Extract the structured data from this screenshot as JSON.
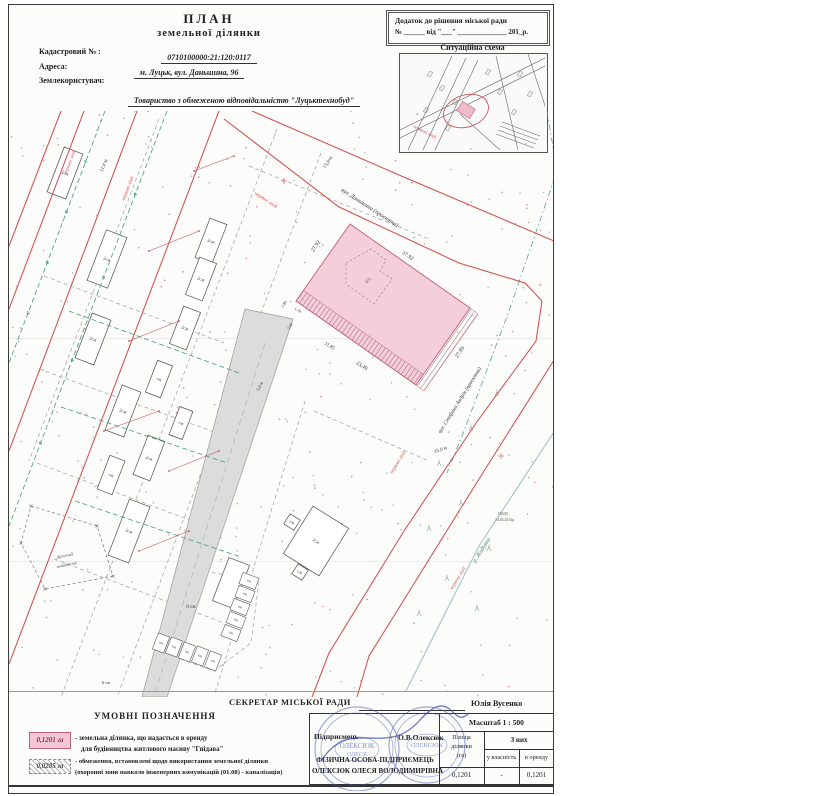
{
  "doc": {
    "title": "ПЛАН",
    "subtitle": "земельної ділянки",
    "cadastral_label": "Кадастровий № :",
    "cadastral_value": "0710100000:21:120:0117",
    "address_label": "Адреса:",
    "address_value": "м. Луцьк, вул. Даньшина, 96",
    "landuser_label": "Землекористувач:",
    "landuser_value": "Товариство з обмеженою відповідальністю \"Луцьктехнобуд\""
  },
  "annex": {
    "line1": "Додаток до рішення міської ради",
    "line2": "№ ______ від \"___\" ______________ 201_р."
  },
  "sitmap_title": "Ситуаційна схема",
  "legend": {
    "title": "УМОВНІ ПОЗНАЧЕННЯ",
    "item1_value": "0,1201 га",
    "item1_line1": "- земельна ділянка, що надається в оренду",
    "item1_line2": "для будівництва житлового масиву \"Гнідава\"",
    "item2_value": "0,0285 га",
    "item2_line1": "- обмеження, встановлені щодо використання земельної ділянки",
    "item2_line2": "(охоронні зони навколо інженерних комунікацій (01.08) - каналізація)"
  },
  "footer": {
    "secretary_label": "СЕКРЕТАР МІСЬКОЇ РАДИ",
    "secretary_name": "Юлія Вусенко",
    "scale": "Масштаб 1 : 500",
    "entrepreneur_label": "Підприємець",
    "entrepreneur_sign": "О.В.Олексюк",
    "area_col_l1": "Площа",
    "area_col_l2": "ділянки",
    "area_col_l3": "(га)",
    "of_them": "З них",
    "ownership": "у власність",
    "lease": "в оренду",
    "area_value": "0,1201",
    "ownership_value": "-",
    "lease_value": "0,1201",
    "fop_line1": "ФІЗИЧНА ОСОБА-ПІДПРИЄМЕЦЬ",
    "fop_line2": "ОЛЕКСЮК ОЛЕСЯ ВОЛОДИМИРІВНА"
  },
  "stamp": {
    "text1": "ОЛЕКСЮК",
    "text2": "ОЛЕСЯ"
  },
  "map": {
    "width": 544,
    "height": 586,
    "colors": {
      "red": "#d0504e",
      "green": "#3f9e73",
      "teal": "#57a094",
      "river": "#9fc4c4",
      "road_fill": "#dcdcdc",
      "road_edge": "#9a9a9a",
      "dash": "#9f9f9f",
      "plot_fill": "#f2c6d5",
      "plot_edge": "#c06070",
      "hatch": "#8d4550",
      "building": "#4f4f4f",
      "dot": "#b9b1ae",
      "dot2": "#cf9090",
      "text": "#333333"
    },
    "red_lines": [
      [
        [
          215,
          8
        ],
        [
          330,
          96
        ],
        [
          450,
          152
        ],
        [
          516,
          172
        ],
        [
          533,
          190
        ],
        [
          527,
          230
        ],
        [
          467,
          312
        ],
        [
          395,
          420
        ],
        [
          320,
          542
        ],
        [
          303,
          586
        ]
      ],
      [
        [
          243,
          0
        ],
        [
          390,
          64
        ],
        [
          552,
          133
        ]
      ],
      [
        [
          552,
          238
        ],
        [
          470,
          368
        ],
        [
          360,
          545
        ],
        [
          348,
          586
        ]
      ],
      [
        [
          52,
          0
        ],
        [
          0,
          135
        ]
      ],
      [
        [
          75,
          0
        ],
        [
          0,
          198
        ]
      ],
      [
        [
          128,
          0
        ],
        [
          0,
          340
        ]
      ],
      [
        [
          210,
          0
        ],
        [
          0,
          553
        ]
      ]
    ],
    "green_dash": [
      [
        [
          96,
          0
        ],
        [
          0,
          252
        ]
      ],
      [
        [
          158,
          0
        ],
        [
          0,
          415
        ]
      ],
      [
        [
          60,
          200
        ],
        [
          230,
          262
        ]
      ],
      [
        [
          52,
          296
        ],
        [
          218,
          352
        ]
      ],
      [
        [
          66,
          390
        ],
        [
          232,
          446
        ]
      ]
    ],
    "teal_dashdot": [
      [
        538,
        0
      ],
      [
        548,
        60
      ],
      [
        500,
        200
      ],
      [
        455,
        320
      ],
      [
        438,
        362
      ]
    ],
    "river": [
      [
        547,
        318
      ],
      [
        470,
        435
      ],
      [
        397,
        580
      ]
    ],
    "gray_dash": [
      [
        [
          268,
          18
        ],
        [
          52,
          586
        ]
      ],
      [
        [
          312,
          42
        ],
        [
          108,
          586
        ]
      ],
      [
        [
          150,
          8
        ],
        [
          20,
          350
        ]
      ],
      [
        [
          35,
          165
        ],
        [
          215,
          232
        ]
      ],
      [
        [
          30,
          258
        ],
        [
          208,
          322
        ]
      ],
      [
        [
          28,
          352
        ],
        [
          205,
          418
        ]
      ],
      [
        [
          45,
          448
        ],
        [
          215,
          512
        ]
      ],
      [
        [
          240,
          55
        ],
        [
          420,
          128
        ]
      ],
      [
        [
          296,
          290
        ],
        [
          206,
          582
        ]
      ],
      [
        [
          305,
          300
        ],
        [
          420,
          350
        ]
      ],
      [
        [
          168,
          455
        ],
        [
          250,
          470
        ],
        [
          242,
          532
        ],
        [
          205,
          560
        ],
        [
          150,
          540
        ],
        [
          168,
          455
        ]
      ]
    ],
    "road": {
      "poly": [
        [
          236,
          198
        ],
        [
          284,
          208
        ],
        [
          268,
          256
        ],
        [
          158,
          586
        ],
        [
          133,
          586
        ]
      ],
      "center": [
        [
          256,
          232
        ],
        [
          146,
          582
        ]
      ]
    },
    "plot": {
      "poly": [
        [
          341,
          113
        ],
        [
          461,
          197
        ],
        [
          407,
          274
        ],
        [
          287,
          190
        ]
      ],
      "hatch1": [
        [
          287,
          190
        ],
        [
          407,
          274
        ],
        [
          414.5,
          263.4
        ],
        [
          294.5,
          179.4
        ]
      ],
      "hatch2": [
        [
          461,
          197
        ],
        [
          407,
          274
        ],
        [
          415,
          280
        ],
        [
          469,
          203
        ]
      ],
      "inner_dash": [
        [
          337,
          152
        ],
        [
          362,
          138
        ],
        [
          377,
          149
        ],
        [
          371,
          160
        ],
        [
          383,
          168
        ],
        [
          365,
          193
        ],
        [
          337,
          173
        ]
      ]
    },
    "buildings": [
      [
        56,
        62,
        20,
        48,
        21,
        "2сж"
      ],
      [
        98,
        148,
        22,
        54,
        21,
        "2сж"
      ],
      [
        202,
        130,
        18,
        42,
        21,
        "2сж"
      ],
      [
        192,
        168,
        18,
        40,
        21,
        "2сж"
      ],
      [
        176,
        217,
        18,
        40,
        21,
        "2сж"
      ],
      [
        84,
        228,
        20,
        48,
        21,
        "2сж"
      ],
      [
        114,
        300,
        20,
        48,
        21,
        "2сж"
      ],
      [
        150,
        268,
        16,
        34,
        21,
        "сж"
      ],
      [
        140,
        347,
        18,
        42,
        21,
        "2сж"
      ],
      [
        102,
        364,
        16,
        36,
        21,
        "сж"
      ],
      [
        172,
        312,
        14,
        30,
        21,
        "сж"
      ],
      [
        120,
        420,
        22,
        60,
        21,
        "2сж"
      ],
      [
        307,
        430,
        42,
        56,
        32,
        "2сж"
      ],
      [
        283,
        411,
        12,
        12,
        32,
        "сж"
      ],
      [
        291,
        461,
        12,
        12,
        32,
        "сж"
      ],
      [
        222,
        472,
        22,
        46,
        21,
        ""
      ]
    ],
    "garages": [
      {
        "cells": [
          [
            152,
            532
          ],
          [
            165,
            536
          ],
          [
            178,
            541
          ],
          [
            191,
            545
          ],
          [
            204,
            550
          ]
        ],
        "w": 12,
        "h": 17,
        "r": 21,
        "label": "КН"
      },
      {
        "cells": [
          [
            222,
            522
          ],
          [
            227,
            509
          ],
          [
            231,
            496
          ],
          [
            236,
            483
          ],
          [
            240,
            470
          ]
        ],
        "w": 17,
        "h": 12,
        "r": 21,
        "label": "КН"
      }
    ],
    "playground": {
      "poly": [
        [
          22,
          395
        ],
        [
          88,
          415
        ],
        [
          104,
          465
        ],
        [
          36,
          478
        ],
        [
          12,
          432
        ]
      ]
    },
    "red_segments": [
      [
        [
          140,
          140
        ],
        [
          190,
          120
        ]
      ],
      [
        [
          120,
          230
        ],
        [
          170,
          210
        ]
      ],
      [
        [
          95,
          320
        ],
        [
          150,
          300
        ]
      ],
      [
        [
          160,
          360
        ],
        [
          210,
          340
        ]
      ],
      [
        [
          185,
          60
        ],
        [
          225,
          45
        ]
      ],
      [
        [
          130,
          440
        ],
        [
          180,
          420
        ]
      ]
    ],
    "marks": {
      "plus": [
        [
          275,
          70
        ],
        [
          492,
          345
        ]
      ],
      "veg": [
        [
          430,
          355
        ],
        [
          462,
          320
        ],
        [
          488,
          285
        ],
        [
          420,
          420
        ],
        [
          452,
          395
        ],
        [
          480,
          440
        ],
        [
          438,
          470
        ],
        [
          410,
          505
        ],
        [
          468,
          500
        ]
      ]
    },
    "labels": [
      {
        "t": "вул. Даньшина (проектна)",
        "x": 360,
        "y": 98,
        "r": 33,
        "s": 6,
        "c": "text",
        "i": true
      },
      {
        "t": "вул. Стефана Андрія (проектна)",
        "x": 452,
        "y": 290,
        "r": -58,
        "s": 5.5,
        "c": "text",
        "i": true
      },
      {
        "t": "р. Жидувка",
        "x": 474,
        "y": 440,
        "r": -58,
        "s": 6,
        "c": "#3d7d7d",
        "i": true
      },
      {
        "t": "червоні лінії",
        "x": 62,
        "y": 52,
        "r": -69,
        "s": 5,
        "c": "red",
        "i": true
      },
      {
        "t": "червоні лінії",
        "x": 120,
        "y": 78,
        "r": -69,
        "s": 5,
        "c": "red",
        "i": true
      },
      {
        "t": "червоні лінії",
        "x": 256,
        "y": 90,
        "r": 33,
        "s": 5,
        "c": "red",
        "i": true
      },
      {
        "t": "червоні лінії",
        "x": 415,
        "y": 22,
        "r": 27,
        "s": 5,
        "c": "red",
        "i": true
      },
      {
        "t": "червоні лінії",
        "x": 390,
        "y": 352,
        "r": -58,
        "s": 5,
        "c": "red",
        "i": true
      },
      {
        "t": "червоні лінії",
        "x": 450,
        "y": 468,
        "r": -58,
        "s": 5,
        "c": "red",
        "i": true
      },
      {
        "t": "15,0 м",
        "x": 320,
        "y": 52,
        "r": -57,
        "s": 5,
        "c": "text",
        "i": false
      },
      {
        "t": "15,0 м",
        "x": 432,
        "y": 340,
        "r": -20,
        "s": 5,
        "c": "text",
        "i": false
      },
      {
        "t": "11,0 м",
        "x": 96,
        "y": 55,
        "r": -69,
        "s": 5,
        "c": "text",
        "i": false
      },
      {
        "t": "5,0 м",
        "x": 252,
        "y": 276,
        "r": -62,
        "s": 4.5,
        "c": "text",
        "i": false
      },
      {
        "t": "37,92",
        "x": 398,
        "y": 146,
        "r": 33,
        "s": 5.5,
        "c": "text",
        "i": false
      },
      {
        "t": "27,92",
        "x": 308,
        "y": 136,
        "r": -55,
        "s": 5.5,
        "c": "text",
        "i": false
      },
      {
        "t": "27,89",
        "x": 452,
        "y": 242,
        "r": -55,
        "s": 5.5,
        "c": "text",
        "i": false
      },
      {
        "t": "23,49",
        "x": 352,
        "y": 256,
        "r": 33,
        "s": 5.5,
        "c": "text",
        "i": false
      },
      {
        "t": "11,85",
        "x": 320,
        "y": 236,
        "r": 33,
        "s": 5,
        "c": "text",
        "i": false
      },
      {
        "t": "1,78",
        "x": 288,
        "y": 200,
        "r": 33,
        "s": 4,
        "c": "text",
        "i": false
      },
      {
        "t": "2,89",
        "x": 276,
        "y": 194,
        "r": -55,
        "s": 4,
        "c": "text",
        "i": false
      },
      {
        "t": "2,60",
        "x": 282,
        "y": 216,
        "r": -55,
        "s": 4,
        "c": "text",
        "i": false
      },
      {
        "t": "б/д",
        "x": 360,
        "y": 170,
        "r": -55,
        "s": 4.5,
        "c": "#555555",
        "i": false
      },
      {
        "t": "9 сж",
        "x": 182,
        "y": 497,
        "r": 0,
        "s": 5,
        "c": "text",
        "i": false
      },
      {
        "t": "6 сж",
        "x": 97,
        "y": 573,
        "r": 0,
        "s": 4.5,
        "c": "text",
        "i": false
      },
      {
        "t": "Дитячий",
        "x": 56,
        "y": 446,
        "r": -12,
        "s": 4.5,
        "c": "#555555",
        "i": true
      },
      {
        "t": "майданчик",
        "x": 58,
        "y": 455,
        "r": -12,
        "s": 4.5,
        "c": "#555555",
        "i": true
      },
      {
        "t": "180,80",
        "x": 494,
        "y": 404,
        "r": 0,
        "s": 3.8,
        "c": "#555555",
        "i": false
      },
      {
        "t": "14.04.2014р.",
        "x": 496,
        "y": 410,
        "r": 0,
        "s": 3.8,
        "c": "#555555",
        "i": false
      }
    ],
    "dots": {
      "count": 300,
      "seed": 11
    }
  },
  "sitmap": {
    "streets": [
      [
        [
          8,
          96
        ],
        [
          52,
          2
        ]
      ],
      [
        [
          22,
          98
        ],
        [
          66,
          4
        ]
      ],
      [
        [
          34,
          98
        ],
        [
          78,
          6
        ]
      ],
      [
        [
          0,
          76
        ],
        [
          145,
          4
        ]
      ],
      [
        [
          0,
          84
        ],
        [
          145,
          12
        ]
      ],
      [
        [
          96,
          2
        ],
        [
          118,
          96
        ]
      ],
      [
        [
          128,
          0
        ],
        [
          147,
          58
        ]
      ],
      [
        [
          60,
          60
        ],
        [
          100,
          96
        ]
      ]
    ],
    "rail": [
      [
        [
          100,
          72
        ],
        [
          138,
          86
        ]
      ],
      [
        [
          98,
          76
        ],
        [
          136,
          90
        ]
      ],
      [
        [
          96,
          80
        ],
        [
          134,
          94
        ]
      ],
      [
        [
          102,
          68
        ],
        [
          140,
          82
        ]
      ]
    ],
    "buildings": [
      [
        30,
        20
      ],
      [
        42,
        34
      ],
      [
        55,
        48
      ],
      [
        26,
        56
      ],
      [
        88,
        18
      ],
      [
        100,
        38
      ],
      [
        114,
        58
      ],
      [
        48,
        74
      ],
      [
        120,
        20
      ],
      [
        130,
        40
      ]
    ],
    "plot": {
      "x": 66,
      "y": 56,
      "w": 15,
      "h": 11,
      "r": 32
    },
    "circle": {
      "x": 66,
      "y": 57,
      "rx": 23,
      "ry": 16,
      "rot": -18
    }
  }
}
